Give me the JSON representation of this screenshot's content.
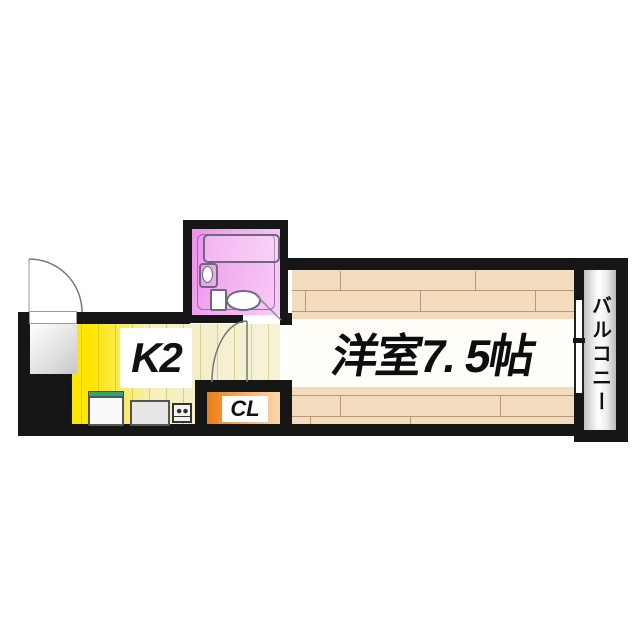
{
  "floorplan": {
    "kind": "apartment floor plan",
    "labels": {
      "kitchen": "K2",
      "room": "洋室7. 5帖",
      "closet": "CL",
      "balcony": "バルコニー"
    },
    "rooms_visible": [
      "entrance",
      "kitchen",
      "unit-bathroom",
      "western-room",
      "closet",
      "balcony"
    ]
  },
  "colors": {
    "wall": "#161616",
    "kitchen_yellow": "#ffe600",
    "kitchen_pale": "#f3efcd",
    "wood_floor": "#f3dcbd",
    "wood_line": "#b6987a",
    "bath_pink": "#ef8fee",
    "bath_pink_light": "#f7cdf7",
    "closet_orange": "#ee7d12",
    "fixture_green": "#2fa17e",
    "balcony_gray": "#c2c2c2"
  }
}
